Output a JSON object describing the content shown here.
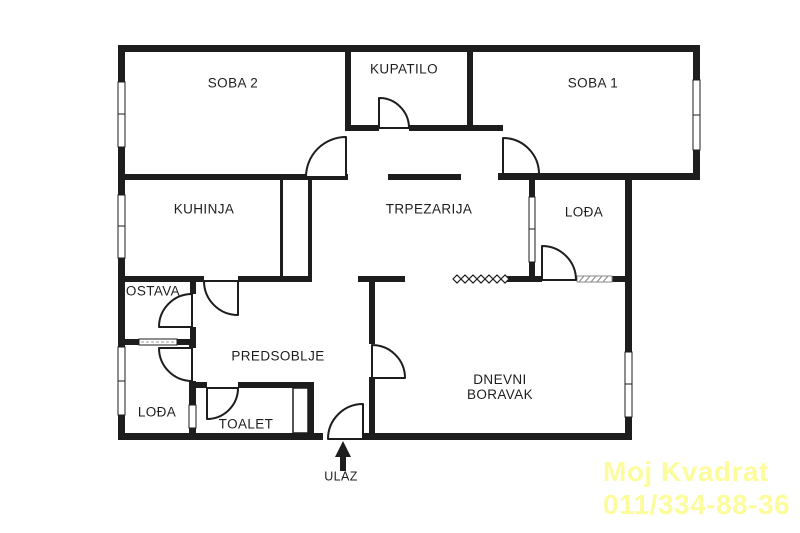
{
  "floorplan": {
    "rooms": [
      {
        "id": "soba2",
        "label": "SOBA 2"
      },
      {
        "id": "kupatilo",
        "label": "KUPATILO"
      },
      {
        "id": "soba1",
        "label": "SOBA 1"
      },
      {
        "id": "kuhinja",
        "label": "KUHINJA"
      },
      {
        "id": "trpezarija",
        "label": "TRPEZARIJA"
      },
      {
        "id": "lodja-right",
        "label": "LOĐA"
      },
      {
        "id": "ostava",
        "label": "OSTAVA"
      },
      {
        "id": "predsoblje",
        "label": "PREDSOBLJE"
      },
      {
        "id": "dnevni-boravak",
        "label": "DNEVNI BORAVAK"
      },
      {
        "id": "lodja-left",
        "label": "LOĐA"
      },
      {
        "id": "toalet",
        "label": "TOALET"
      }
    ],
    "entrance": {
      "label": "ULAZ"
    },
    "watermark": {
      "line1": "Moj Kvadrat",
      "line2": "011/334-88-36",
      "color": "#fcfc9d"
    },
    "colors": {
      "wall": "#1d1d1d",
      "background": "#ffffff"
    }
  }
}
